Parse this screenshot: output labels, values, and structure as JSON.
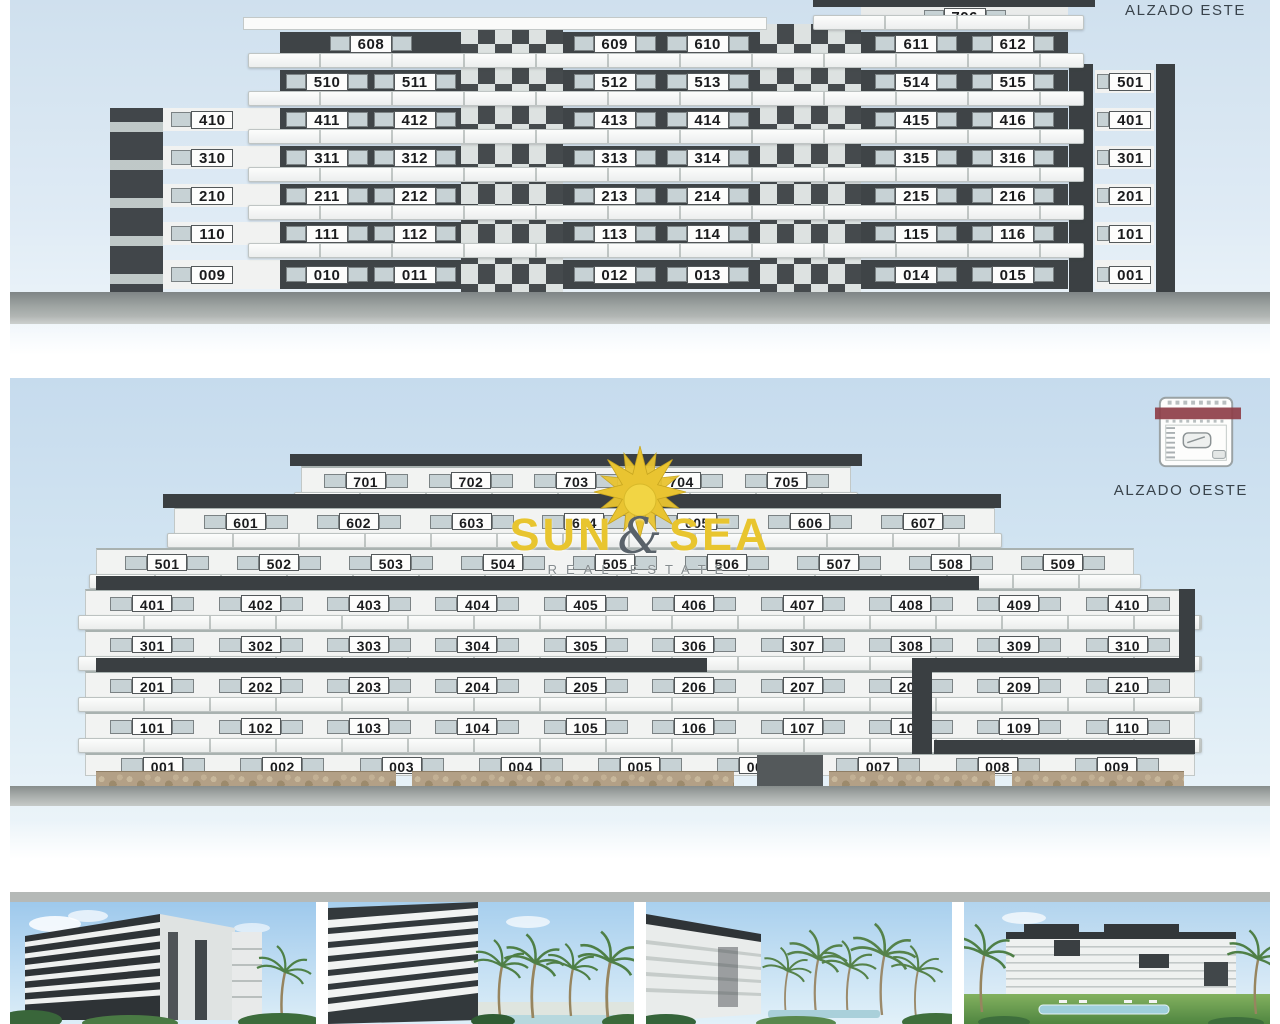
{
  "panels": {
    "east": {
      "title": "ALZADO ESTE",
      "rows": [
        {
          "id": "A",
          "segments": [
            {
              "area": "right-wing",
              "units": [
                "706"
              ]
            }
          ]
        },
        {
          "id": "B",
          "segments": [
            {
              "area": "left-wing",
              "units": [
                "608"
              ]
            },
            {
              "area": "center",
              "units": [
                "609",
                "610"
              ]
            },
            {
              "area": "right-wing",
              "units": [
                "611",
                "612"
              ]
            }
          ]
        },
        {
          "id": "C",
          "segments": [
            {
              "area": "left-wing",
              "units": [
                "510",
                "511"
              ]
            },
            {
              "area": "center",
              "units": [
                "512",
                "513"
              ]
            },
            {
              "area": "right-wing",
              "units": [
                "514",
                "515"
              ]
            },
            {
              "area": "right-tower",
              "units": [
                "501"
              ]
            }
          ]
        },
        {
          "id": "D",
          "segments": [
            {
              "area": "left-tower",
              "units": [
                "410"
              ]
            },
            {
              "area": "left-wing",
              "units": [
                "411",
                "412"
              ]
            },
            {
              "area": "center",
              "units": [
                "413",
                "414"
              ]
            },
            {
              "area": "right-wing",
              "units": [
                "415",
                "416"
              ]
            },
            {
              "area": "right-tower",
              "units": [
                "401"
              ]
            }
          ]
        },
        {
          "id": "E",
          "segments": [
            {
              "area": "left-tower",
              "units": [
                "310"
              ]
            },
            {
              "area": "left-wing",
              "units": [
                "311",
                "312"
              ]
            },
            {
              "area": "center",
              "units": [
                "313",
                "314"
              ]
            },
            {
              "area": "right-wing",
              "units": [
                "315",
                "316"
              ]
            },
            {
              "area": "right-tower",
              "units": [
                "301"
              ]
            }
          ]
        },
        {
          "id": "F",
          "segments": [
            {
              "area": "left-tower",
              "units": [
                "210"
              ]
            },
            {
              "area": "left-wing",
              "units": [
                "211",
                "212"
              ]
            },
            {
              "area": "center",
              "units": [
                "213",
                "214"
              ]
            },
            {
              "area": "right-wing",
              "units": [
                "215",
                "216"
              ]
            },
            {
              "area": "right-tower",
              "units": [
                "201"
              ]
            }
          ]
        },
        {
          "id": "G",
          "segments": [
            {
              "area": "left-tower",
              "units": [
                "110"
              ]
            },
            {
              "area": "left-wing",
              "units": [
                "111",
                "112"
              ]
            },
            {
              "area": "center",
              "units": [
                "113",
                "114"
              ]
            },
            {
              "area": "right-wing",
              "units": [
                "115",
                "116"
              ]
            },
            {
              "area": "right-tower",
              "units": [
                "101"
              ]
            }
          ]
        },
        {
          "id": "H",
          "segments": [
            {
              "area": "left-tower",
              "units": [
                "009"
              ]
            },
            {
              "area": "left-wing",
              "units": [
                "010",
                "011"
              ]
            },
            {
              "area": "center",
              "units": [
                "012",
                "013"
              ]
            },
            {
              "area": "right-wing",
              "units": [
                "014",
                "015"
              ]
            },
            {
              "area": "right-tower",
              "units": [
                "001"
              ]
            }
          ]
        }
      ]
    },
    "west": {
      "title": "ALZADO OESTE",
      "rows": [
        {
          "id": "7",
          "units": [
            "701",
            "702",
            "703",
            "704",
            "705"
          ]
        },
        {
          "id": "6",
          "units": [
            "601",
            "602",
            "603",
            "604",
            "605",
            "606",
            "607"
          ]
        },
        {
          "id": "5",
          "units": [
            "501",
            "502",
            "503",
            "504",
            "505",
            "506",
            "507",
            "508",
            "509"
          ]
        },
        {
          "id": "4",
          "units": [
            "401",
            "402",
            "403",
            "404",
            "405",
            "406",
            "407",
            "408",
            "409",
            "410"
          ]
        },
        {
          "id": "3",
          "units": [
            "301",
            "302",
            "303",
            "304",
            "305",
            "306",
            "307",
            "308",
            "309",
            "310"
          ]
        },
        {
          "id": "2",
          "units": [
            "201",
            "202",
            "203",
            "204",
            "205",
            "206",
            "207",
            "208",
            "209",
            "210"
          ]
        },
        {
          "id": "1",
          "units": [
            "101",
            "102",
            "103",
            "104",
            "105",
            "106",
            "107",
            "108",
            "109",
            "110"
          ]
        },
        {
          "id": "0",
          "units": [
            "001",
            "002",
            "003",
            "004",
            "005",
            "006",
            "007",
            "008",
            "009"
          ]
        }
      ]
    }
  },
  "logo": {
    "word1": "SUN",
    "amp": "&",
    "word2": "SEA",
    "tagline": "REAL ESTATE"
  },
  "colors": {
    "facade-dark": "#3f4447",
    "sky-top": "#cfe0ee",
    "logo-yellow": "#e8c52f",
    "logo-amp-gray": "#59626a",
    "tagline-gray": "#858c8f",
    "plan-band-red": "#8e3e48",
    "stone-tan": "#b3a086",
    "ground-gray": "#8f9594",
    "glass": "#c7d2d5"
  }
}
